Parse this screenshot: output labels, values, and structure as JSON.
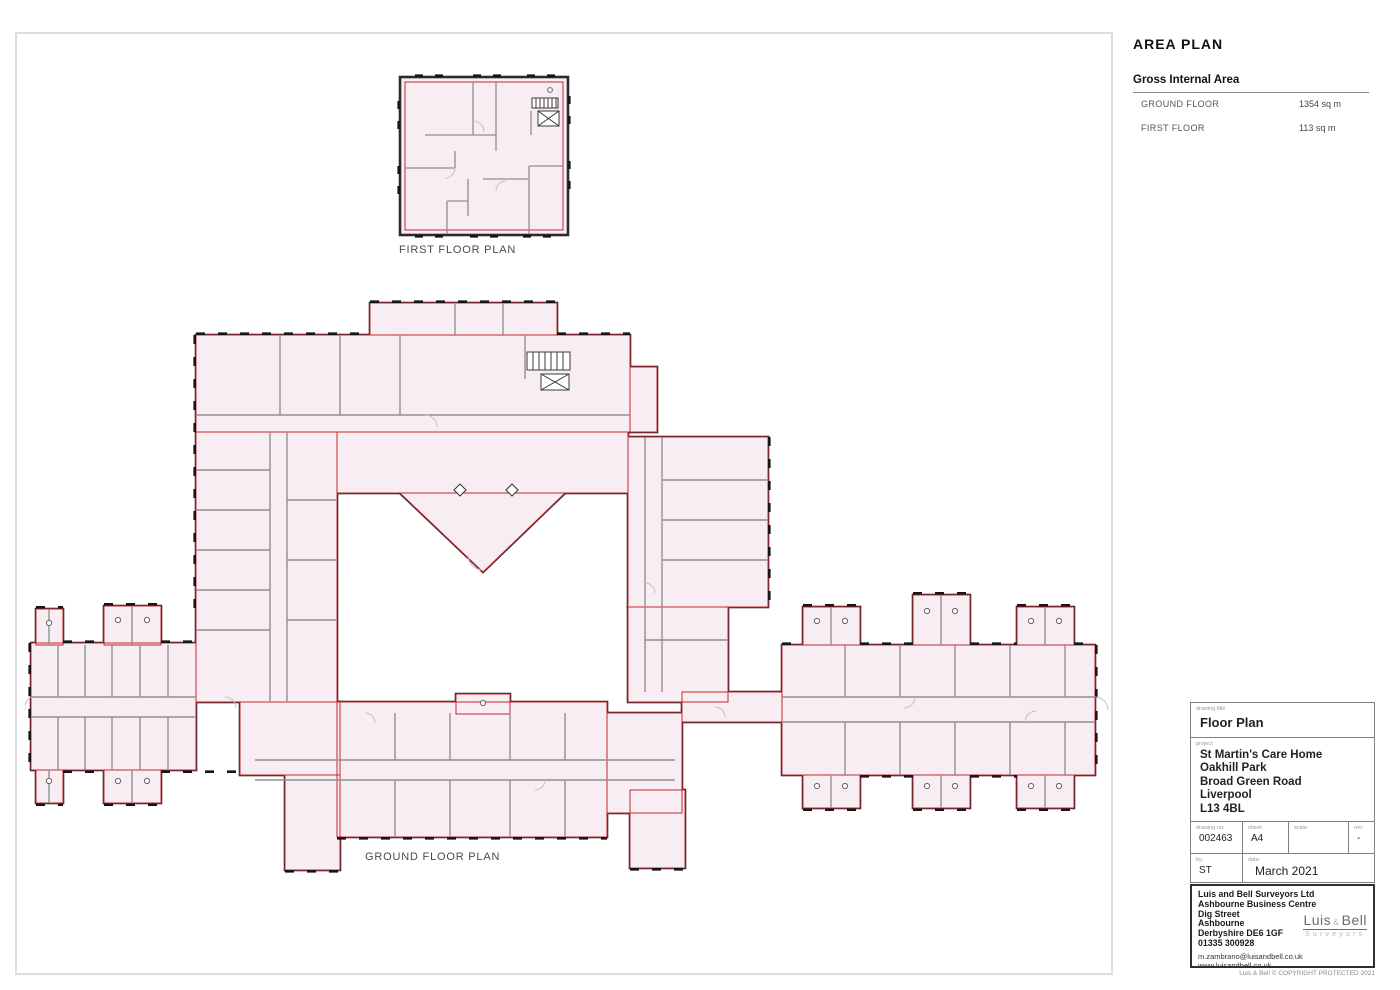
{
  "area_plan": {
    "title": "AREA PLAN",
    "table_title": "Gross Internal Area",
    "rows": [
      {
        "label": "GROUND FLOOR",
        "value": "1354 sq m"
      },
      {
        "label": "FIRST FLOOR",
        "value": "113 sq m"
      }
    ]
  },
  "plans": {
    "first_floor_label": "FIRST FLOOR PLAN",
    "ground_floor_label": "GROUND FLOOR PLAN"
  },
  "title_block": {
    "drawing_title_label": "drawing title",
    "drawing_title": "Floor Plan",
    "project_label": "project",
    "project_lines": [
      "St Martin's Care Home",
      "Oakhill Park",
      "Broad Green Road",
      "Liverpool",
      "L13 4BL"
    ],
    "drawing_no_label": "drawing no:",
    "drawing_no": "002463",
    "sheet_label": "sheet:",
    "sheet": "A4",
    "scale_label": "scale:",
    "scale": "",
    "rev_label": "rev:",
    "rev": "-",
    "by_label": "by:",
    "by": "ST",
    "date_label": "date:",
    "date": "March 2021",
    "company": {
      "lines": [
        "Luis and Bell Surveyors Ltd",
        "Ashbourne Business Centre",
        "Dig Street",
        "Ashbourne",
        "Derbyshire DE6 1GF",
        "01335 300928"
      ],
      "email": "m.zambrano@luisandbell.co.uk",
      "website": "www.luisandbell.co.uk"
    },
    "logo": {
      "word1": "Luis",
      "amp": "&",
      "word2": "Bell",
      "subtitle": "Surveyors"
    },
    "copyright": "Luis & Bell © COPYRIGHT PROTECTED 2021"
  },
  "colors": {
    "plan_fill": "#f8edf3",
    "gia_outline_red": "#c4262e",
    "wall_black": "#2b2b2b",
    "partition_gray": "#909090",
    "logo_accent": "#a2544c"
  }
}
